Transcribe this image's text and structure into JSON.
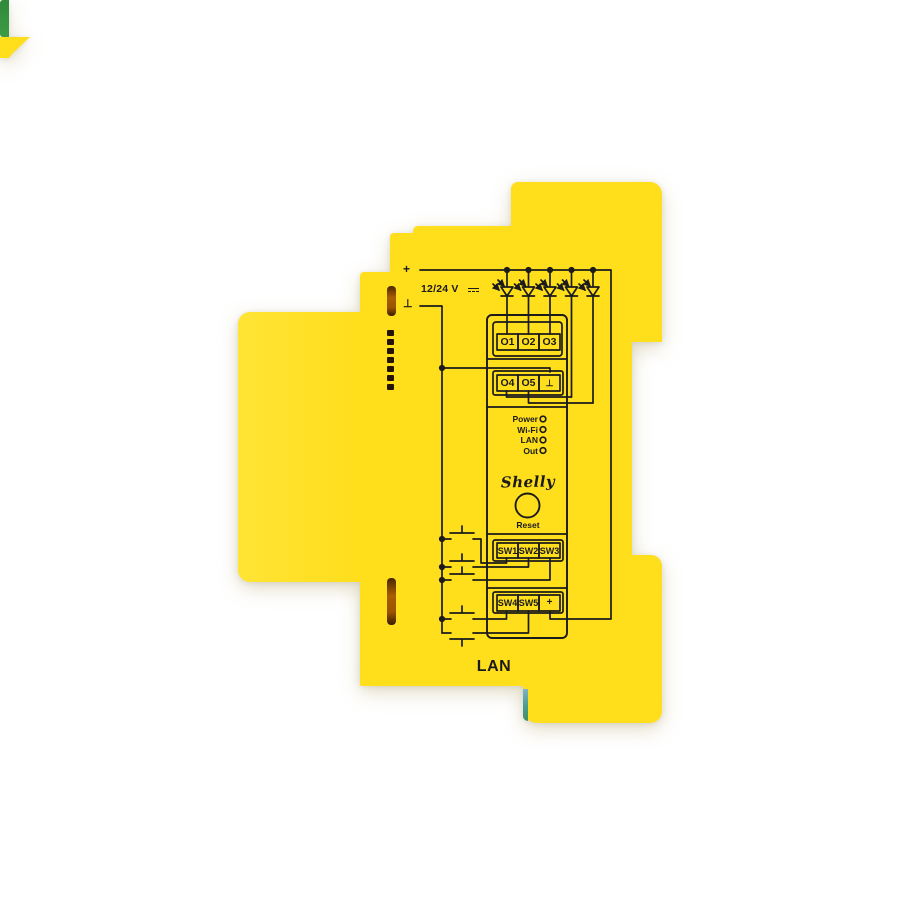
{
  "device": {
    "brand": "Shelly",
    "power_input": {
      "voltage": "12/24 V",
      "plus": "+",
      "ground": "⊥"
    },
    "terminals": {
      "outputs_row1": [
        "O1",
        "O2",
        "O3"
      ],
      "outputs_row2": [
        "O4",
        "O5",
        "⊥"
      ],
      "switch_row1": [
        "SW1",
        "SW2",
        "SW3"
      ],
      "switch_row2": [
        "SW4",
        "SW5",
        "+"
      ]
    },
    "status_leds": [
      "Power",
      "Wi-Fi",
      "LAN",
      "Out"
    ],
    "reset_button": "Reset",
    "port_label": "LAN",
    "colors": {
      "body": "#ffde1c",
      "body_light": "#ffe435",
      "accent_green": "#3d9b45",
      "accent_teal": "#4a9b8e",
      "slot": "#9a5400",
      "ink": "#1b1b1b",
      "background": "#ffffff"
    }
  }
}
